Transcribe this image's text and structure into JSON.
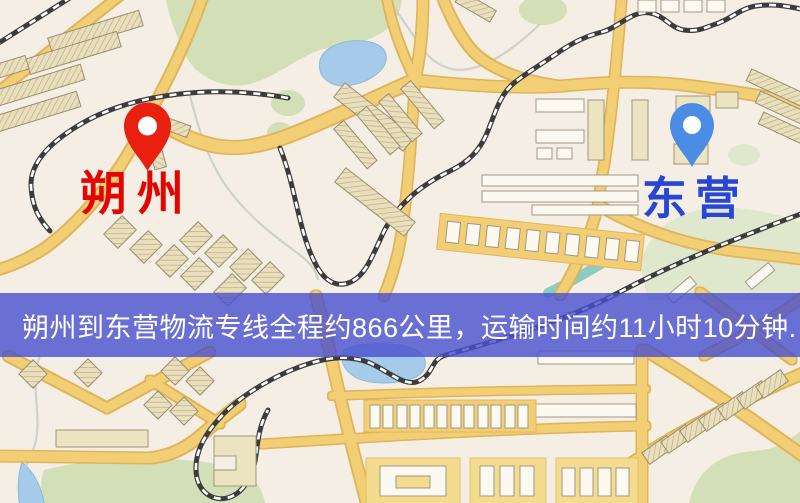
{
  "map": {
    "origin": {
      "name": "朔州",
      "pin_color": "#e8200f",
      "label_color": "#e60400"
    },
    "destination": {
      "name": "东营",
      "pin_color": "#4b8ce4",
      "label_color": "#2746d6"
    },
    "banner": {
      "text": "朔州到东营物流专线全程约866公里，运输时间约11小时10分钟.",
      "background": "#474ece",
      "text_color": "#ffffff"
    },
    "route": {
      "distance_text": "约866公里",
      "duration_text": "约11小时10分钟"
    },
    "palette": {
      "background": "#f4eee4",
      "road": "#f2cf74",
      "park": "#d3dfb6",
      "water": "#a6cae9",
      "railway": "#3c3c3c",
      "building": "#e9dfbd"
    }
  }
}
